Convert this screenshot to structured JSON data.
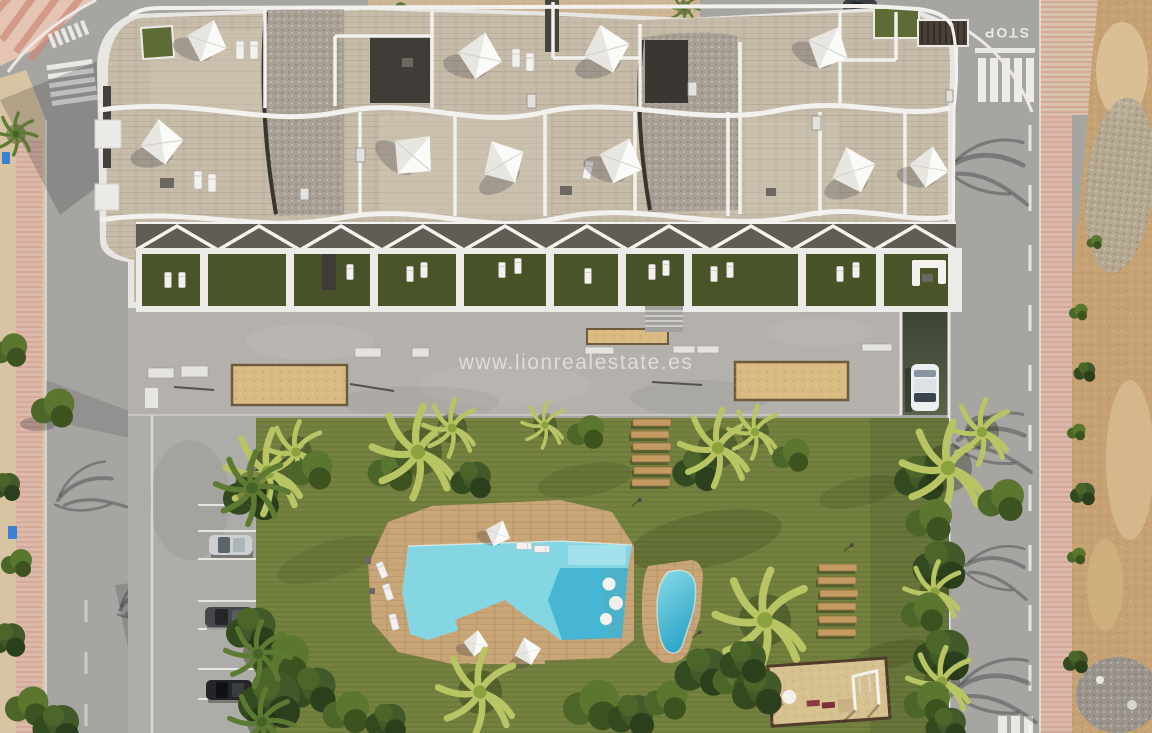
{
  "meta": {
    "description": "Aerial 3D render of a modern apartment complex with rooftop terraces, communal garden, two swimming pools, playground, parking bays and surrounding streets next to a vacant sandy lot",
    "canvas": {
      "width": 1152,
      "height": 733
    }
  },
  "watermark": {
    "text": "www.lionrealestate.es"
  },
  "road_markings": {
    "stop_text": "STOP"
  },
  "palette": {
    "road": "#a7a5a2",
    "plaza": "#b4b1ad",
    "driveway": "#aeaca8",
    "lawn": "#74813f",
    "hedge_lawn": "#68763a",
    "terrace_green": "#4a5429",
    "stone": "#c7bcaa",
    "gravel": "#a9a095",
    "roof_white": "#e8e6e2",
    "dark_roof": "#403c37",
    "deck_tan": "#c8a678",
    "pool_light": "#84d6e3",
    "pool_mid": "#5bc6dd",
    "pool_deep": "#3fb2d2",
    "sand_planter": "#d9ba80",
    "dirt": "#c6a173",
    "sand_strip": "#d8c3a2",
    "pink_sidewalk": "#dcb9aa",
    "ramp_green": "#4a5342",
    "sail_white": "#fafaf8",
    "playground_sand": "#d8c190",
    "wood_plank": "#c49a63",
    "white_car": "#eceff0",
    "silver_car": "#cdd0d2",
    "dark_car": "#45474a",
    "black_car": "#232528",
    "blue_bin": "#3d7fd0"
  },
  "scene": {
    "setting": "Aerial view of residential building with communal pool garden",
    "counts": {
      "shade_sails": 10,
      "ground_floor_gardens": 10,
      "parked_cars": 3,
      "driving_cars": 2,
      "pools": 2,
      "sand_planters": 3,
      "wood_path_sets": 2
    },
    "features": [
      "rooftop-terraces",
      "pergola-canopy",
      "communal-lawn",
      "main-pool",
      "kids-pool",
      "playground",
      "parking-bays",
      "garage-ramp",
      "stop-marking",
      "crosswalks",
      "vacant-lot"
    ]
  }
}
